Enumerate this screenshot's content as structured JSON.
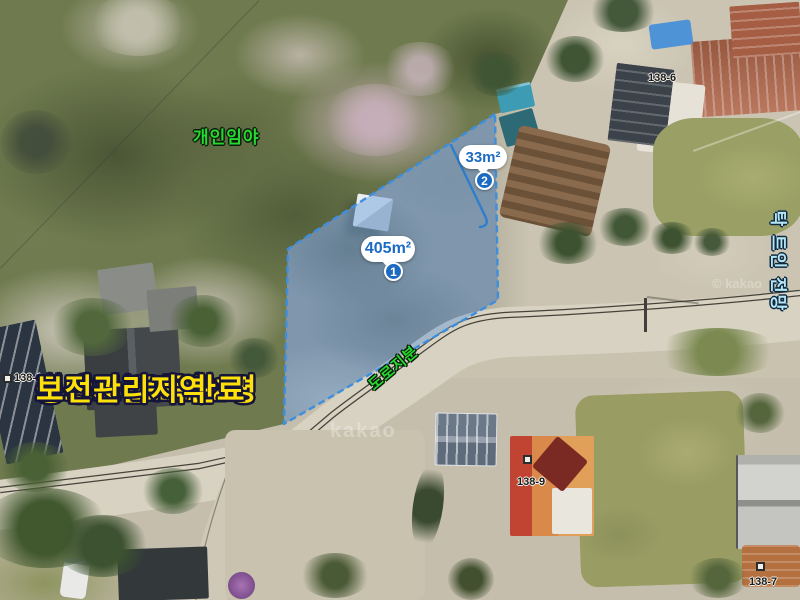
{
  "overlay": {
    "forest_label": "개인임야",
    "road_label": "도로지분",
    "view_label": "탁 트인 전망",
    "parcels": [
      {
        "area": "405m²",
        "badge": "1"
      },
      {
        "area": "33m²",
        "badge": "2"
      }
    ],
    "info_lines": [
      "총대지 134.82평",
      "도로지분 포함",
      "보강토 토목완료",
      "평탄지",
      "보전관리지역"
    ],
    "lot_labels": {
      "left": "138-1",
      "top_right": "138-6",
      "center": "138-9",
      "bottom_right": "138-7"
    },
    "watermarks": {
      "center": "kakao",
      "right": "© kakao"
    },
    "colors": {
      "parcel_fill": "rgba(100,155,215,0.45)",
      "parcel_stroke": "#3E8EDE",
      "bubble_text": "#1C6BC2",
      "info_text": "#FFE10A",
      "green_label": "#26D92E",
      "view_label": "#B5E6F2"
    }
  }
}
